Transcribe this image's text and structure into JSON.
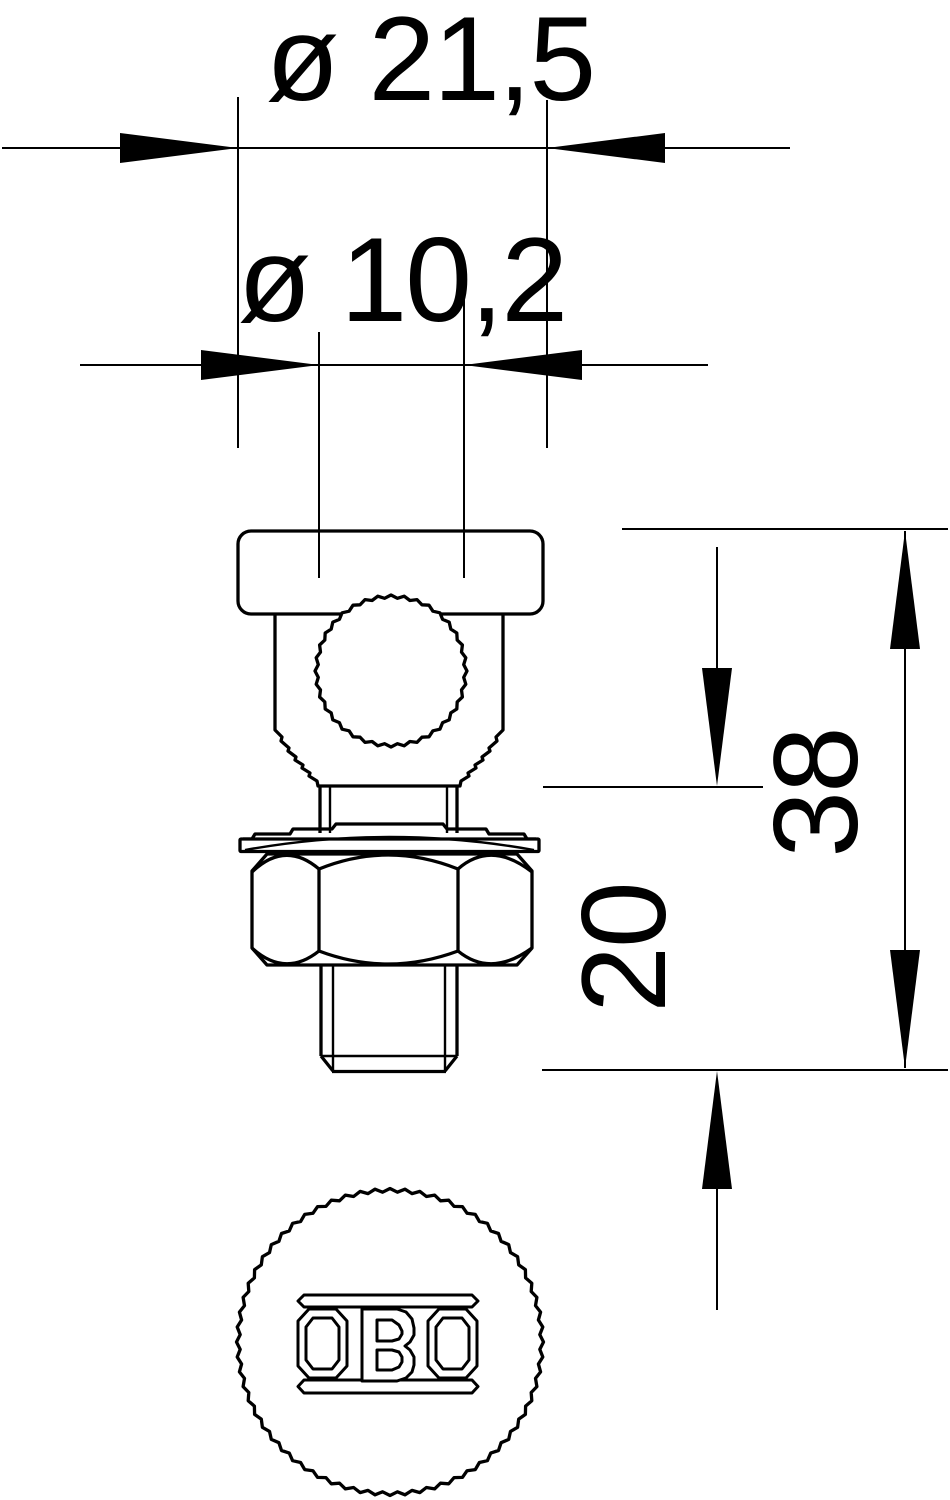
{
  "colors": {
    "line": "#000000",
    "background": "#ffffff"
  },
  "dimensions": {
    "head_diameter": {
      "label": "ø 21,5",
      "value": 21.5
    },
    "bore_diameter": {
      "label": "ø 10,2",
      "value": 10.2
    },
    "overall_height": {
      "label": "38",
      "value": 38
    },
    "clamp_height": {
      "label": "20",
      "value": 20
    }
  },
  "logo_text": "OBO"
}
